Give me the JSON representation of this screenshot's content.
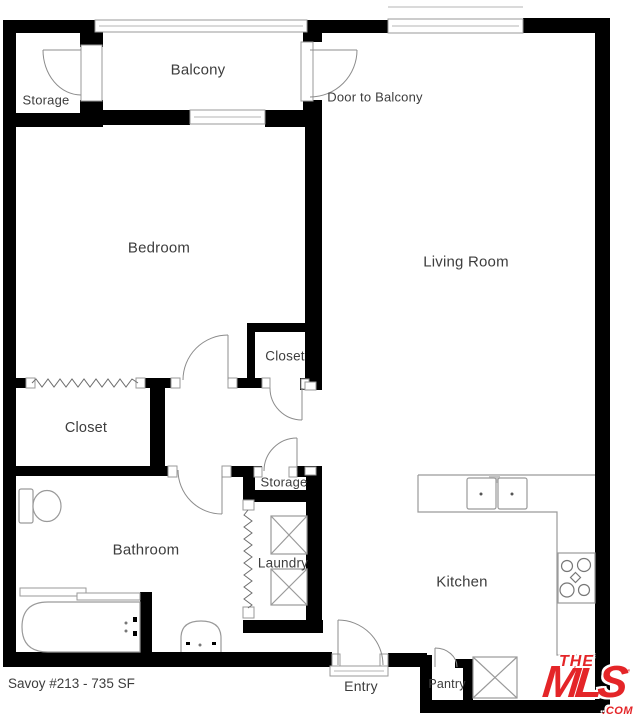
{
  "plan": {
    "footer": "Savoy #213 - 735 SF",
    "labels": {
      "balcony": "Balcony",
      "storage_balcony": "Storage",
      "door_to_balcony": "Door to Balcony",
      "bedroom": "Bedroom",
      "living_room": "Living Room",
      "closet_bedroom": "Closet",
      "closet_walkin": "Closet",
      "storage_hall": "Storage",
      "bathroom": "Bathroom",
      "laundry": "Laundry",
      "kitchen": "Kitchen",
      "entry": "Entry",
      "pantry": "Pantry"
    },
    "logo": {
      "the": "THE",
      "mls": "MLS",
      "tm": "™",
      "com": ".COM"
    },
    "colors": {
      "wall": "#000000",
      "thin_line": "#9a9a9a",
      "label_text": "#3d3d3d",
      "logo_red": "#e42528"
    }
  }
}
